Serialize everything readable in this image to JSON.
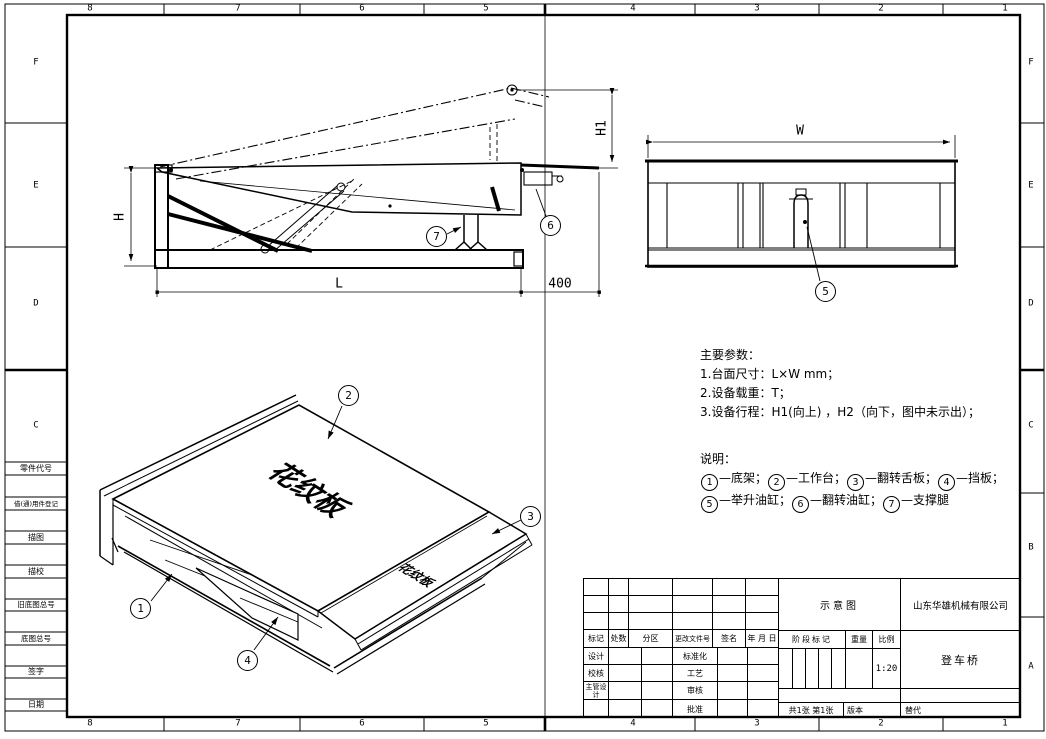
{
  "colors": {
    "line": "#000000",
    "background": "#ffffff"
  },
  "frame": {
    "top_zones": [
      "8",
      "7",
      "6",
      "5",
      "4",
      "3",
      "2",
      "1"
    ],
    "bottom_zones": [
      "8",
      "7",
      "6",
      "5",
      "4",
      "3",
      "2",
      "1"
    ],
    "left_zones": [
      "F",
      "E",
      "D",
      "C"
    ],
    "right_zones": [
      "F",
      "E",
      "D",
      "C",
      "B",
      "A"
    ],
    "margin_labels": [
      "零件代号",
      "借(通)用件登记",
      "描图",
      "描校",
      "旧底图总号",
      "底图总号",
      "签字",
      "日期"
    ]
  },
  "side_view": {
    "dim_height": "H",
    "dim_lift": "H1",
    "dim_length": "L",
    "dim_rear": "400",
    "callout_support_leg": "7",
    "callout_flip_cylinder": "6"
  },
  "front_view": {
    "dim_width": "W",
    "callout_lift_cylinder": "5"
  },
  "isometric_view": {
    "callout_base_frame": "1",
    "callout_platform": "2",
    "callout_lip": "3",
    "callout_side_plate": "4",
    "platform_text": "花纹板",
    "lip_text": "花纹板"
  },
  "parameters": {
    "title": "主要参数：",
    "line1": "1.台面尺寸：L×W mm；",
    "line2": "2.设备载重：T；",
    "line3": "3.设备行程：H1(向上) ，H2（向下，图中未示出）；"
  },
  "notes": {
    "title": "说明：",
    "items": [
      {
        "num": "1",
        "label": "—底架；"
      },
      {
        "num": "2",
        "label": "—工作台；"
      },
      {
        "num": "3",
        "label": "—翻转舌板；"
      },
      {
        "num": "4",
        "label": "—挡板；"
      },
      {
        "num": "5",
        "label": "—举升油缸；"
      },
      {
        "num": "6",
        "label": "—翻转油缸；"
      },
      {
        "num": "7",
        "label": "—支撑腿"
      }
    ]
  },
  "title_block": {
    "doc_type": "示意图",
    "company": "山东华雄机械有限公司",
    "product": "登车桥",
    "rev_headers": [
      "标记",
      "处数",
      "分区",
      "更改文件号",
      "签名",
      "年 月 日"
    ],
    "role_left": [
      "设计",
      "校核",
      "主管设计"
    ],
    "role_right": [
      "标准化",
      "工艺",
      "审核",
      "批准"
    ],
    "stage_label": "阶段标记",
    "weight_label": "重量",
    "scale_label": "比例",
    "scale_value": "1:20",
    "sheet_info": "共1张  第1张",
    "version_label": "版本",
    "replace_label": "替代"
  }
}
